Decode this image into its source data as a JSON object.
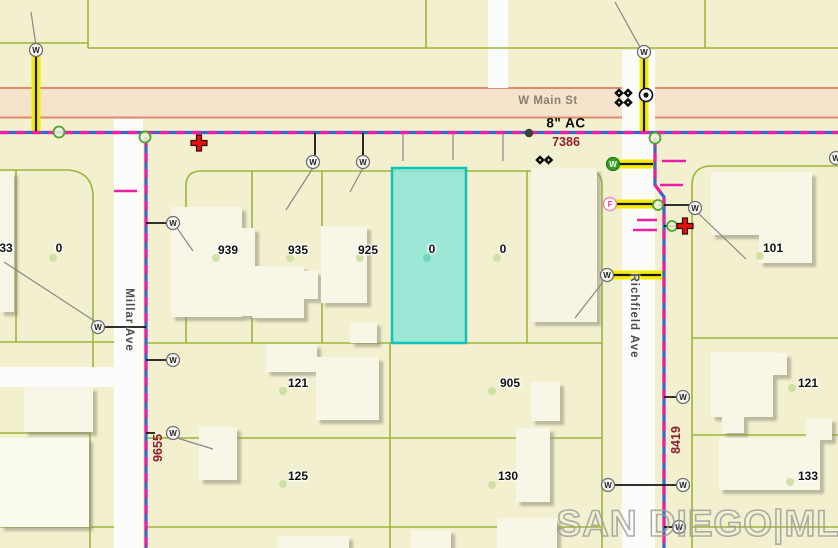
{
  "streets": {
    "main_street": "W Main St",
    "millar": "Millar Ave",
    "richfield": "Richfield Ave"
  },
  "annotations": {
    "water_main_size": "8\" AC",
    "main_node_id": "7386",
    "millar_node_id": "9655",
    "richfield_node_id": "8419"
  },
  "parcels": {
    "p33": "33",
    "p0w": "0",
    "p939": "939",
    "p935": "935",
    "p925": "925",
    "p0sel": "0",
    "p0e": "0",
    "p101": "101",
    "p121w": "121",
    "p905": "905",
    "p121e": "121",
    "p125": "125",
    "p130": "130",
    "p133": "133"
  },
  "symbols": {
    "water_glyph": "W",
    "fire_glyph": "F"
  },
  "watermark": "SAN DIEGO|MLS",
  "colors": {
    "background": "#F2F0CE",
    "highlight_parcel_fill": "#8FE5D6",
    "highlight_parcel_stroke": "#12C3BA",
    "water_line_blue": "#3B63C8",
    "water_line_magenta": "#ED1FA2",
    "highlight_segment_yellow": "#F6EC00",
    "parcel_line": "#9CB43C",
    "road_band_fill": "#F6E3CC",
    "road_band_border": "#DD8A70",
    "node_text": "#8E1F2F"
  }
}
